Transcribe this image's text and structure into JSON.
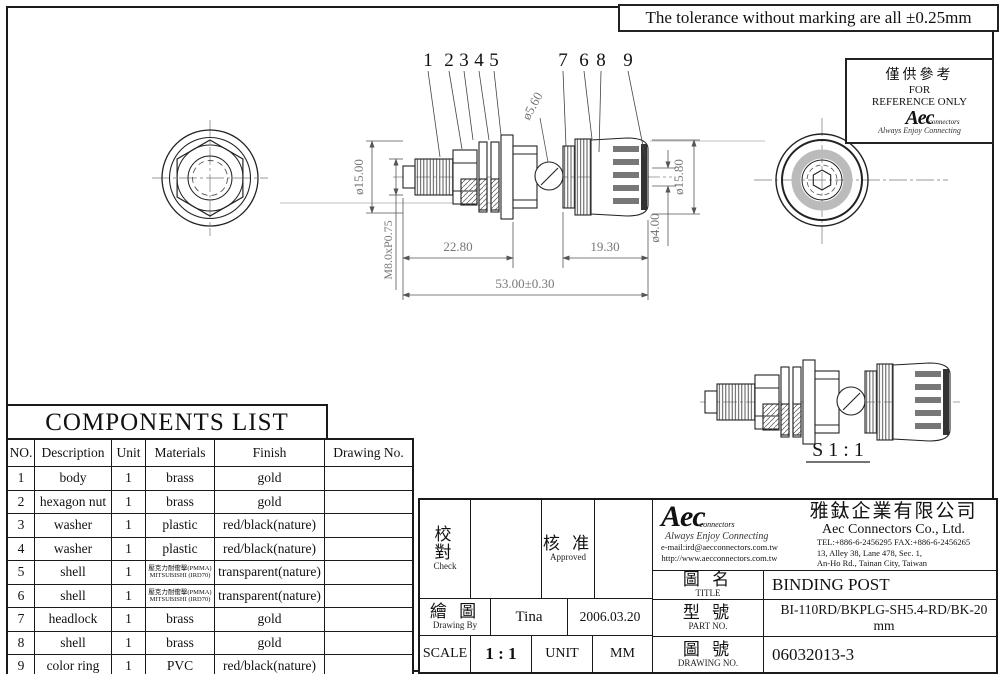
{
  "tolerance_note": "The tolerance without marking are all ±0.25mm",
  "reference_box": {
    "zh": "僅供參考",
    "line1": "FOR",
    "line2": "REFERENCE ONLY",
    "logo_text": "Aec",
    "logo_sub": "connectors",
    "logo_script": "Always Enjoy Connecting"
  },
  "drawing": {
    "callouts": [
      "1",
      "2",
      "3",
      "4",
      "5",
      "7",
      "6",
      "8",
      "9"
    ],
    "dia_hole": "ø5.60",
    "dia_left": "ø15.00",
    "thread": "M8.0xP0.75",
    "dia_cap": "ø15.80",
    "dia_pin": "ø4.00",
    "len_left": "22.80",
    "len_right": "19.30",
    "len_total": "53.00±0.30",
    "scale_view": "S 1 : 1"
  },
  "components_list": {
    "title": "COMPONENTS LIST",
    "headers": [
      "NO.",
      "Description",
      "Unit",
      "Materials",
      "Finish",
      "Drawing No."
    ],
    "rows": [
      {
        "no": "1",
        "desc": "body",
        "unit": "1",
        "mat": "brass",
        "mat2": "",
        "finish": "gold"
      },
      {
        "no": "2",
        "desc": "hexagon nut",
        "unit": "1",
        "mat": "brass",
        "mat2": "",
        "finish": "gold"
      },
      {
        "no": "3",
        "desc": "washer",
        "unit": "1",
        "mat": "plastic",
        "mat2": "",
        "finish": "red/black(nature)"
      },
      {
        "no": "4",
        "desc": "washer",
        "unit": "1",
        "mat": "plastic",
        "mat2": "",
        "finish": "red/black(nature)"
      },
      {
        "no": "5",
        "desc": "shell",
        "unit": "1",
        "mat": "壓克力耐衝擊(PMMA)",
        "mat2": "MITSUBISHI (IRD70)",
        "finish": "transparent(nature)"
      },
      {
        "no": "6",
        "desc": "shell",
        "unit": "1",
        "mat": "壓克力耐衝擊(PMMA)",
        "mat2": "MITSUBISHI (IRD70)",
        "finish": "transparent(nature)"
      },
      {
        "no": "7",
        "desc": "headlock",
        "unit": "1",
        "mat": "brass",
        "mat2": "",
        "finish": "gold"
      },
      {
        "no": "8",
        "desc": "shell",
        "unit": "1",
        "mat": "brass",
        "mat2": "",
        "finish": "gold"
      },
      {
        "no": "9",
        "desc": "color ring",
        "unit": "1",
        "mat": "PVC",
        "mat2": "",
        "finish": "red/black(nature)"
      }
    ]
  },
  "title_block": {
    "check_zh": "校 對",
    "check_en": "Check",
    "approved_zh": "核 准",
    "approved_en": "Approved",
    "drawn_zh": "繪 圖",
    "drawn_en": "Drawing By",
    "drawn_by": "Tina",
    "drawn_date": "2006.03.20",
    "scale_label": "SCALE",
    "scale_value": "1 : 1",
    "unit_label": "UNIT",
    "unit_value": "MM",
    "company_zh": "雅鈦企業有限公司",
    "company_en": "Aec Connectors Co., Ltd.",
    "tel_fax": "TEL:+886-6-2456295  FAX:+886-6-2456265",
    "address1": "13, Alley 38, Lane 478, Sec. 1,",
    "address2": "An-Ho Rd., Tainan City, Taiwan",
    "email": "e-mail:ird@aecconnectors.com.tw",
    "website": "http://www.aecconnectors.com.tw",
    "logo_text": "Aec",
    "logo_sub": "connectors",
    "logo_script": "Always Enjoy Connecting",
    "title_zh": "圖 名",
    "title_en": "TITLE",
    "title_value": "BINDING POST",
    "part_zh": "型 號",
    "part_en": "PART NO.",
    "part_value": "BI-110RD/BKPLG-SH5.4-RD/BK-20mm",
    "dwgno_zh": "圖 號",
    "dwgno_en": "DRAWING NO.",
    "dwgno_value": "06032013-3"
  }
}
